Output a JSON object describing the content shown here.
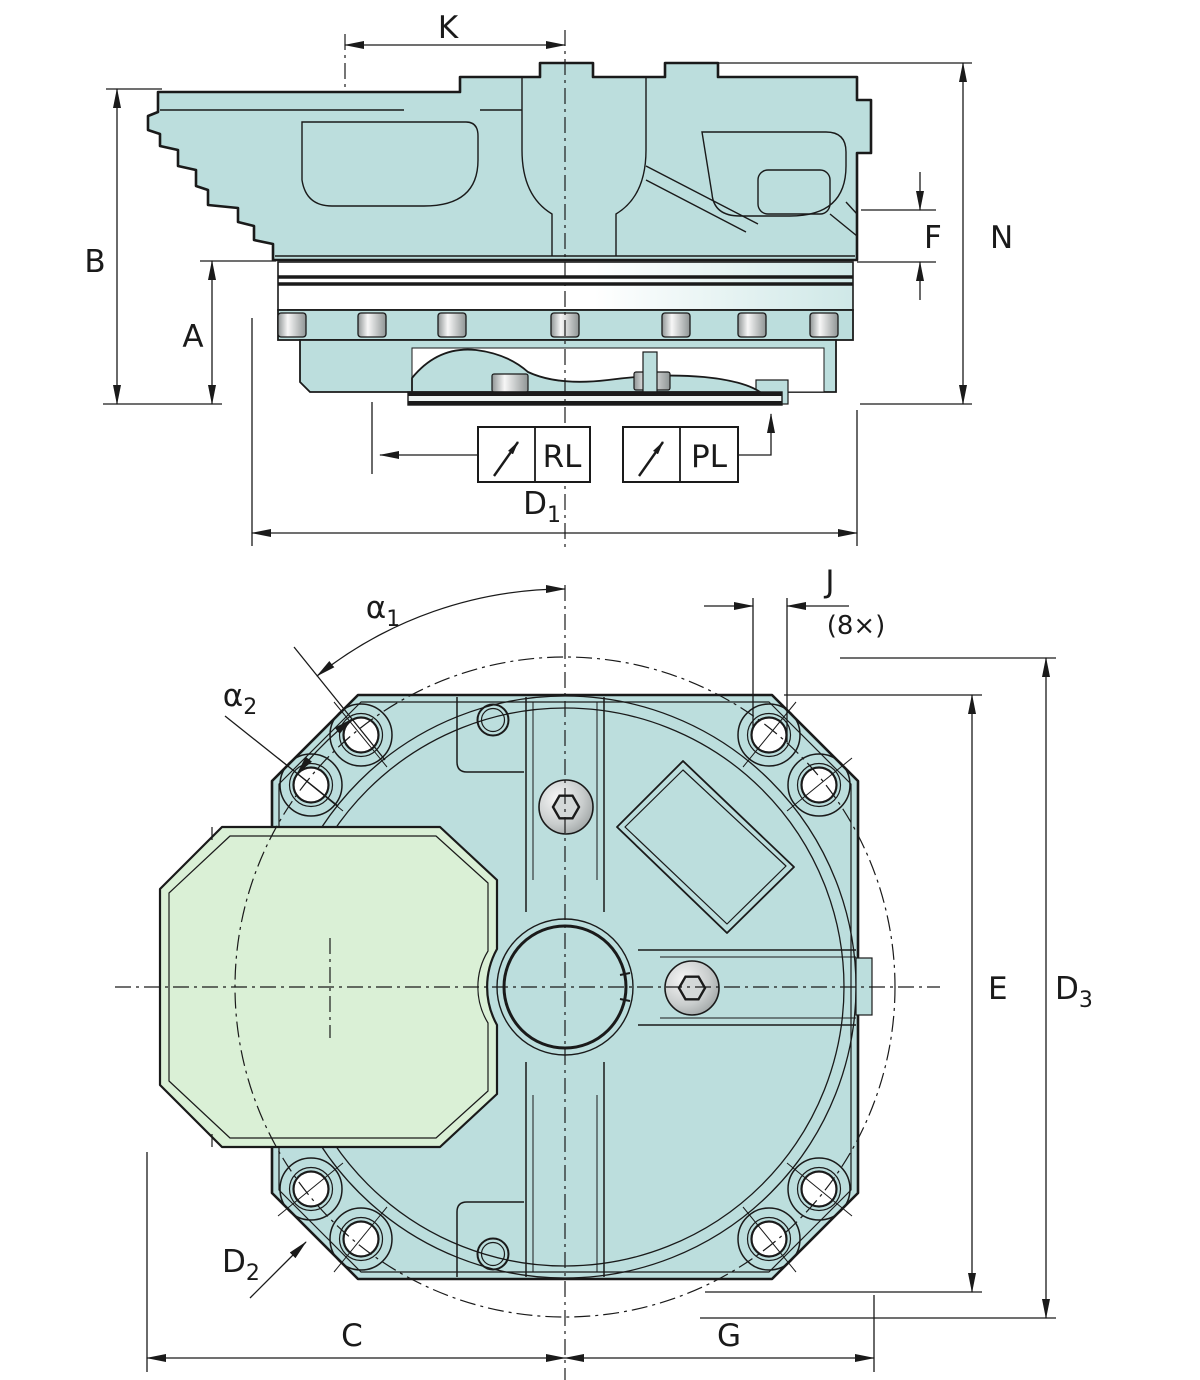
{
  "drawing": {
    "type": "technical-dimension-drawing",
    "views": {
      "side_view": {
        "dim_labels": {
          "K": "K",
          "B": "B",
          "A": "A",
          "F": "F",
          "N": "N",
          "D1_main": "D",
          "D1_sub": "1"
        },
        "callouts": {
          "RL": "RL",
          "PL": "PL"
        }
      },
      "plan_view": {
        "dim_labels": {
          "alpha1_main": "α",
          "alpha1_sub": "1",
          "alpha2_main": "α",
          "alpha2_sub": "2",
          "J": "J",
          "J_count": "(8×)",
          "E": "E",
          "D3_main": "D",
          "D3_sub": "3",
          "D2_main": "D",
          "D2_sub": "2",
          "C": "C",
          "G": "G"
        }
      }
    },
    "bolt_hole_count": 8
  },
  "colors": {
    "line": "#1a1a1a",
    "body": "#bcdedd",
    "cam": "#daf0d6",
    "white": "#ffffff",
    "band_teal": "#cfe8e7",
    "metal_light": "#f7f7f7",
    "metal_mid": "#c9cdcd",
    "metal_dark": "#8f9595",
    "plate_light": "#eef4f3"
  }
}
